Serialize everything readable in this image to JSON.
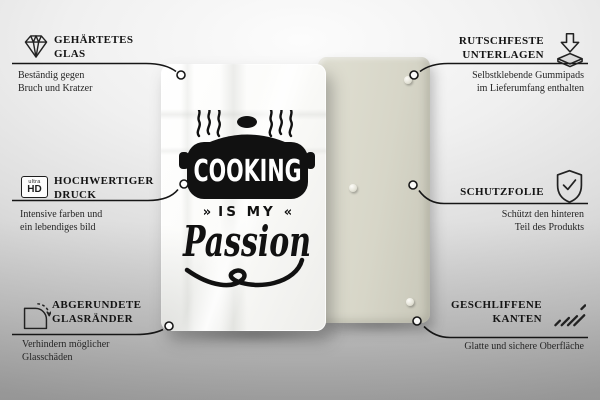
{
  "product": {
    "front_design": {
      "word_cooking": "COOKING",
      "word_is_my": "IS MY",
      "ornament_left": "»",
      "ornament_right": "«",
      "word_passion": "Passion"
    }
  },
  "features": {
    "left": [
      {
        "id": "tempered-glass",
        "icon": "diamond-icon",
        "title_line1": "GEHÄRTETES",
        "title_line2": "GLAS",
        "desc_line1": "Beständig gegen",
        "desc_line2": "Bruch und Kratzer"
      },
      {
        "id": "hd-print",
        "icon": "ultra-hd-icon",
        "icon_label_top": "ultra",
        "icon_label_bottom": "HD",
        "title_line1": "HOCHWERTIGER",
        "title_line2": "DRUCK",
        "desc_line1": "Intensive farben und",
        "desc_line2": "ein lebendiges bild"
      },
      {
        "id": "rounded-glass-edges",
        "icon": "rounded-corner-icon",
        "title_line1": "ABGERUNDETE",
        "title_line2": "GLASRÄNDER",
        "desc_line1": "Verhindern möglicher",
        "desc_line2": "Glasschäden"
      }
    ],
    "right": [
      {
        "id": "anti-slip-pads",
        "icon": "pad-arrow-icon",
        "title_line1": "RUTSCHFESTE",
        "title_line2": "UNTERLAGEN",
        "desc_line1": "Selbstklebende Gummipads",
        "desc_line2": "im Lieferumfang enthalten"
      },
      {
        "id": "protective-film",
        "icon": "shield-check-icon",
        "title_line1": "SCHUTZFOLIE",
        "title_line2": "",
        "desc_line1": "Schützt den hinteren",
        "desc_line2": "Teil des Produkts"
      },
      {
        "id": "polished-edges",
        "icon": "hatch-icon",
        "title_line1": "GESCHLIFFENE",
        "title_line2": "KANTEN",
        "desc_line1": "Glatte und sichere Oberfläche",
        "desc_line2": ""
      }
    ]
  },
  "colors": {
    "ink": "#1a1a1a",
    "glass_white": "#ffffff",
    "panel_beige": "#d7d6c8",
    "background_top": "#fafafa",
    "background_bottom": "#aaaaaa"
  }
}
